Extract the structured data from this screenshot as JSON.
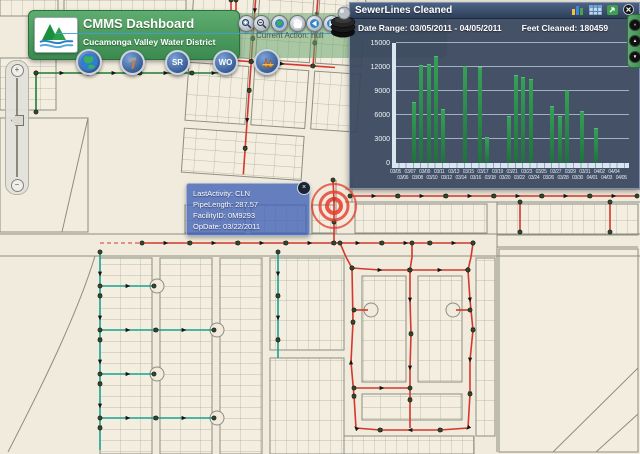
{
  "header": {
    "title": "CMMS Dashboard",
    "subtitle": "Cucamonga Valley Water District",
    "logo": "cvwd-mountains-water-logo"
  },
  "toolbar": {
    "current_action": "Current Action: null",
    "icons": [
      "zoom-in",
      "zoom-out",
      "full-extent",
      "pan",
      "previous-extent",
      "next-extent",
      "layers-stack"
    ]
  },
  "app_buttons": [
    {
      "name": "basemap-globe",
      "label": ""
    },
    {
      "name": "tools-hammer",
      "label": ""
    },
    {
      "name": "service-request",
      "label": "SR"
    },
    {
      "name": "work-order",
      "label": "WO"
    },
    {
      "name": "construction-barricade",
      "label": ""
    }
  ],
  "chart_panel": {
    "title": "SewerLines Cleaned",
    "date_range": "Date Range: 03/05/2011 - 04/05/2011",
    "feet_cleaned": "Feet Cleaned: 180459",
    "icons": [
      "bar-chart",
      "data-table",
      "export",
      "close"
    ]
  },
  "chart_data": {
    "type": "bar",
    "title": "SewerLines Cleaned",
    "categories": [
      "03/05",
      "03/06",
      "03/07",
      "03/08",
      "03/09",
      "03/10",
      "03/11",
      "03/12",
      "03/13",
      "03/14",
      "03/15",
      "03/16",
      "03/17",
      "03/18",
      "03/19",
      "03/20",
      "03/21",
      "03/22",
      "03/23",
      "03/24",
      "03/25",
      "03/26",
      "03/27",
      "03/28",
      "03/29",
      "03/30",
      "03/31",
      "04/01",
      "04/02",
      "04/03",
      "04/04",
      "04/05"
    ],
    "values": [
      0,
      0,
      7500,
      12100,
      12200,
      13300,
      6600,
      0,
      0,
      12000,
      0,
      11900,
      3100,
      0,
      0,
      5800,
      10900,
      10600,
      10400,
      0,
      0,
      7000,
      5700,
      9000,
      0,
      6400,
      0,
      4200,
      0,
      0,
      0,
      0
    ],
    "xlabel": "",
    "ylabel": "",
    "ylim": [
      0,
      15000
    ],
    "yticks": [
      0,
      3000,
      6000,
      9000,
      12000,
      15000
    ],
    "grid": true,
    "legend": null,
    "bar_color": "#2e8b4f",
    "date_range": "03/05/2011 - 04/05/2011",
    "feet_cleaned": 180459
  },
  "map_popup": {
    "lines": [
      "LastActivity: CLN",
      "PipeLength: 287.57",
      "FacilityID: 0M9293",
      "OpDate: 03/22/2011"
    ],
    "close_glyph": "×"
  },
  "zoom_slider": {
    "plus": "+",
    "minus": "−"
  },
  "right_strip": {
    "buttons": [
      "»",
      "▲",
      "▼"
    ]
  },
  "colors": {
    "header_green": "#4c9b5e",
    "panel_bg": "#3c4a60",
    "bar_green": "#2e8b4f",
    "sewer_red": "#d4372c",
    "sewer_teal": "#17a093",
    "sewer_green": "#1e7d33",
    "map_beige": "#f0ebdc"
  }
}
